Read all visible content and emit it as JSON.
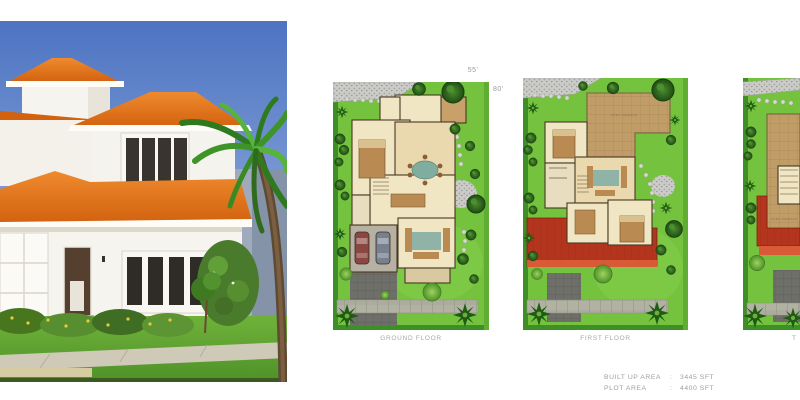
{
  "page": {
    "background": "#ffffff"
  },
  "hero": {
    "name": "villa-exterior-render"
  },
  "dimensions": {
    "width": "55'",
    "depth": "80'"
  },
  "plans": [
    {
      "caption": "GROUND FLOOR"
    },
    {
      "caption": "FIRST FLOOR"
    },
    {
      "caption": "T"
    }
  ],
  "rooms": {
    "open_terrace": "OPEN TERRACE"
  },
  "area_summary": {
    "rows": [
      {
        "label": "BUILT UP AREA",
        "sep": ":",
        "value": "3445 SFT"
      },
      {
        "label": "PLOT AREA",
        "sep": ":",
        "value": "4400 SFT"
      }
    ]
  },
  "colors": {
    "roof_orange": "#e0701c",
    "lawn_green": "#74c23e",
    "terrace_brown": "#c09d67",
    "tile_roof_red": "#bf3a22",
    "label_gray": "#a7a7a7",
    "sky_blue": "#5b7fc7"
  }
}
